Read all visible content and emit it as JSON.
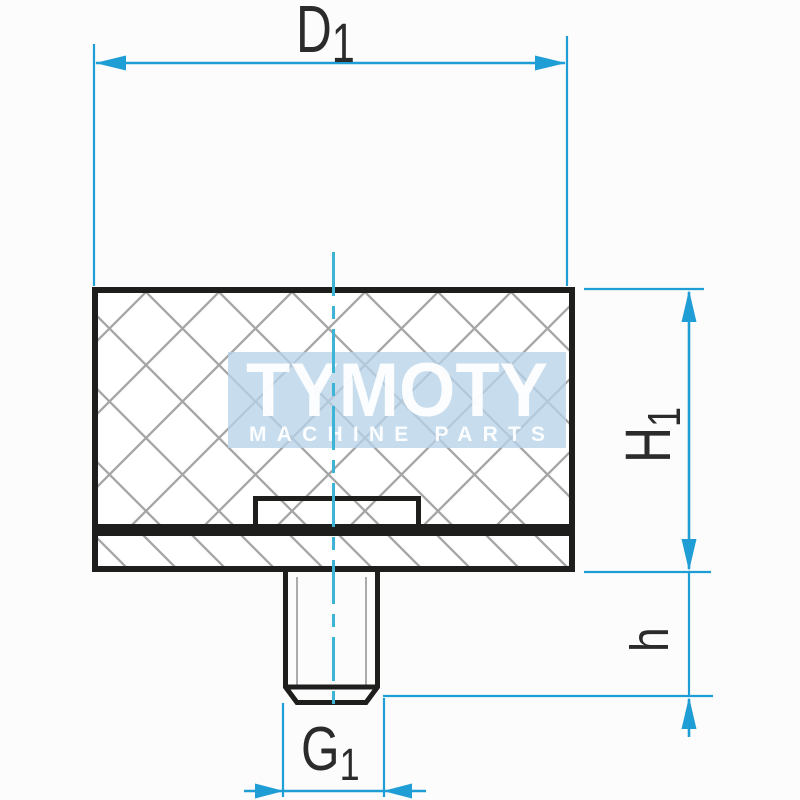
{
  "dimensions": {
    "d1": {
      "label": "D",
      "sub": "1"
    },
    "h1": {
      "label": "H",
      "sub": "1"
    },
    "h": {
      "label": "h",
      "sub": ""
    },
    "g1": {
      "label": "G",
      "sub": "1"
    }
  },
  "watermark": {
    "title": "TYMOTY",
    "subtitle": "MACHINE PARTS"
  },
  "colors": {
    "background": "#fcfcfc",
    "dimension": "#1f9ed6",
    "centerline": "#3db3d6",
    "outline": "#1e1e1c",
    "hatch": "#9c9c9c",
    "label": "#2b2b2b",
    "watermark_bg": "#b7d3e9",
    "watermark_text": "#ffffff"
  }
}
